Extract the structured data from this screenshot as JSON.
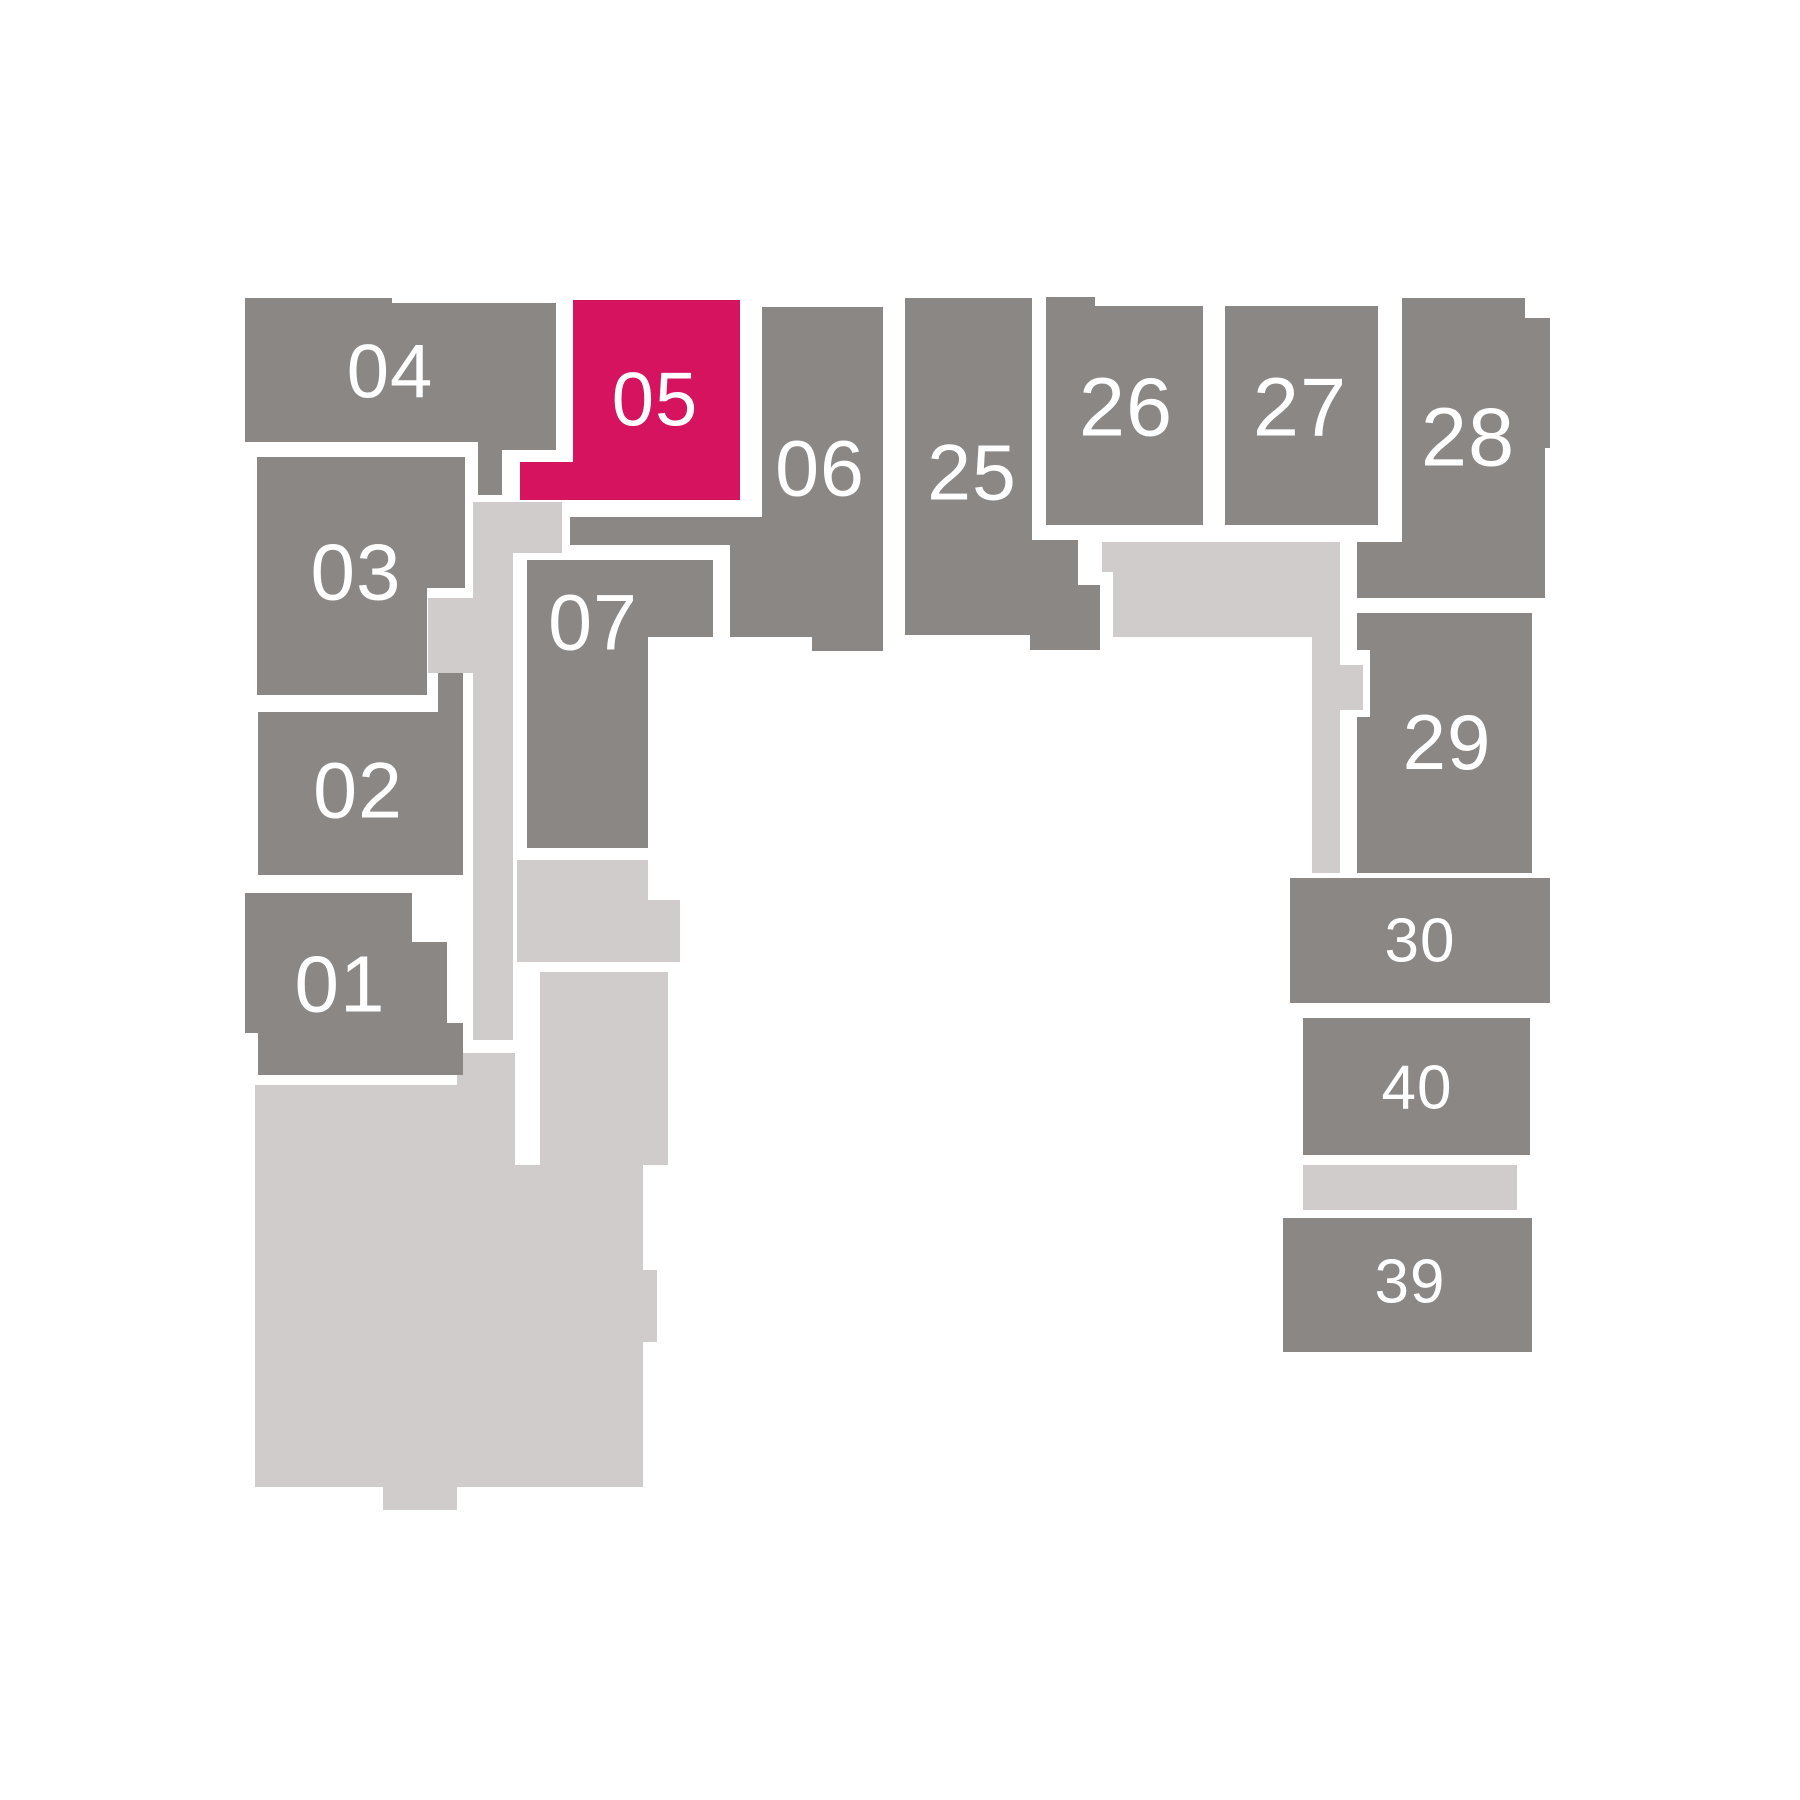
{
  "title": "Floor plan unit selector",
  "selected_unit": "05",
  "colors": {
    "unit_fill": "#8b8785",
    "highlight_fill": "#d6135f",
    "common_fill": "#cfcccb",
    "background": "#ffffff",
    "label_text": "#ffffff"
  },
  "plan": {
    "units": [
      {
        "id": "04",
        "label": "04",
        "state": "available",
        "label_x": 390,
        "label_y": 372,
        "label_size": 76,
        "points": "245,298 392,298 392,303 556,303 556,450 502,450 502,495 478,495 478,442 245,442"
      },
      {
        "id": "05",
        "label": "05",
        "state": "selected",
        "label_x": 655,
        "label_y": 400,
        "label_size": 76,
        "points": "573,300 740,300 740,500 520,500 520,462 573,462"
      },
      {
        "id": "06",
        "label": "06",
        "state": "available",
        "label_x": 820,
        "label_y": 468,
        "label_size": 79,
        "points": "762,307 883,307 883,651 812,651 812,637 730,637 730,545 570,545 570,517 762,517"
      },
      {
        "id": "03",
        "label": "03",
        "state": "available",
        "label_x": 356,
        "label_y": 572,
        "label_size": 80,
        "points": "257,457 465,457 465,588 427,588 427,695 257,695"
      },
      {
        "id": "07",
        "label": "07",
        "state": "available",
        "label_x": 593,
        "label_y": 622,
        "label_size": 79,
        "points": "527,560 713,560 713,637 648,637 648,848 527,848"
      },
      {
        "id": "02",
        "label": "02",
        "state": "available",
        "label_x": 358,
        "label_y": 790,
        "label_size": 79,
        "points": "258,712 438,712 438,673 463,673 463,875 258,875"
      },
      {
        "id": "01",
        "label": "01",
        "state": "available",
        "label_x": 340,
        "label_y": 984,
        "label_size": 80,
        "points": "245,893 412,893 412,942 447,942 447,1023 463,1023 463,1075 258,1075 258,1033 245,1033"
      },
      {
        "id": "25",
        "label": "25",
        "state": "available",
        "label_x": 972,
        "label_y": 472,
        "label_size": 79,
        "points": "905,298 1032,298 1032,540 1078,540 1078,585 1100,585 1100,650 1030,650 1030,635 905,635"
      },
      {
        "id": "26",
        "label": "26",
        "state": "available",
        "label_x": 1126,
        "label_y": 407,
        "label_size": 83,
        "points": "1046,297 1095,297 1095,306 1203,306 1203,525 1046,525"
      },
      {
        "id": "27",
        "label": "27",
        "state": "available",
        "label_x": 1300,
        "label_y": 407,
        "label_size": 83,
        "points": "1225,306 1378,306 1378,525 1225,525"
      },
      {
        "id": "28",
        "label": "28",
        "state": "available",
        "label_x": 1468,
        "label_y": 437,
        "label_size": 83,
        "points": "1402,298 1525,298 1525,318 1550,318 1550,448 1545,448 1545,598 1357,598 1357,542 1402,542"
      },
      {
        "id": "29",
        "label": "29",
        "state": "available",
        "label_x": 1447,
        "label_y": 742,
        "label_size": 78,
        "points": "1357,613 1532,613 1532,873 1357,873 1357,717 1370,717 1370,650 1357,650"
      },
      {
        "id": "30",
        "label": "30",
        "state": "available",
        "label_x": 1420,
        "label_y": 941,
        "label_size": 62,
        "points": "1290,878 1550,878 1550,1003 1290,1003"
      },
      {
        "id": "40",
        "label": "40",
        "state": "available",
        "label_x": 1417,
        "label_y": 1088,
        "label_size": 62,
        "points": "1303,1018 1530,1018 1530,1155 1303,1155"
      },
      {
        "id": "39",
        "label": "39",
        "state": "available",
        "label_x": 1410,
        "label_y": 1282,
        "label_size": 62,
        "points": "1283,1218 1532,1218 1532,1352 1283,1352"
      }
    ],
    "common_areas": [
      {
        "id": "corridor-west",
        "points": "473,502 562,502 562,553 513,553 513,1040 473,1040 473,673 428,673 428,598 473,598"
      },
      {
        "id": "corridor-east",
        "points": "1102,542 1340,542 1340,665 1363,665 1363,710 1340,710 1340,873 1312,873 1312,637 1113,637 1113,572 1102,572"
      },
      {
        "id": "landing-mid",
        "points": "517,860 648,860 648,900 680,900 680,962 517,962"
      },
      {
        "id": "strip-east",
        "points": "1303,1165 1517,1165 1517,1210 1303,1210"
      },
      {
        "id": "lobby-south",
        "points": "255,1085 457,1085 457,1053 515,1053 515,1165 540,1165 540,972 668,972 668,1165 643,1165 643,1270 657,1270 657,1342 643,1342 643,1487 457,1487 457,1510 383,1510 383,1487 255,1487"
      }
    ]
  }
}
